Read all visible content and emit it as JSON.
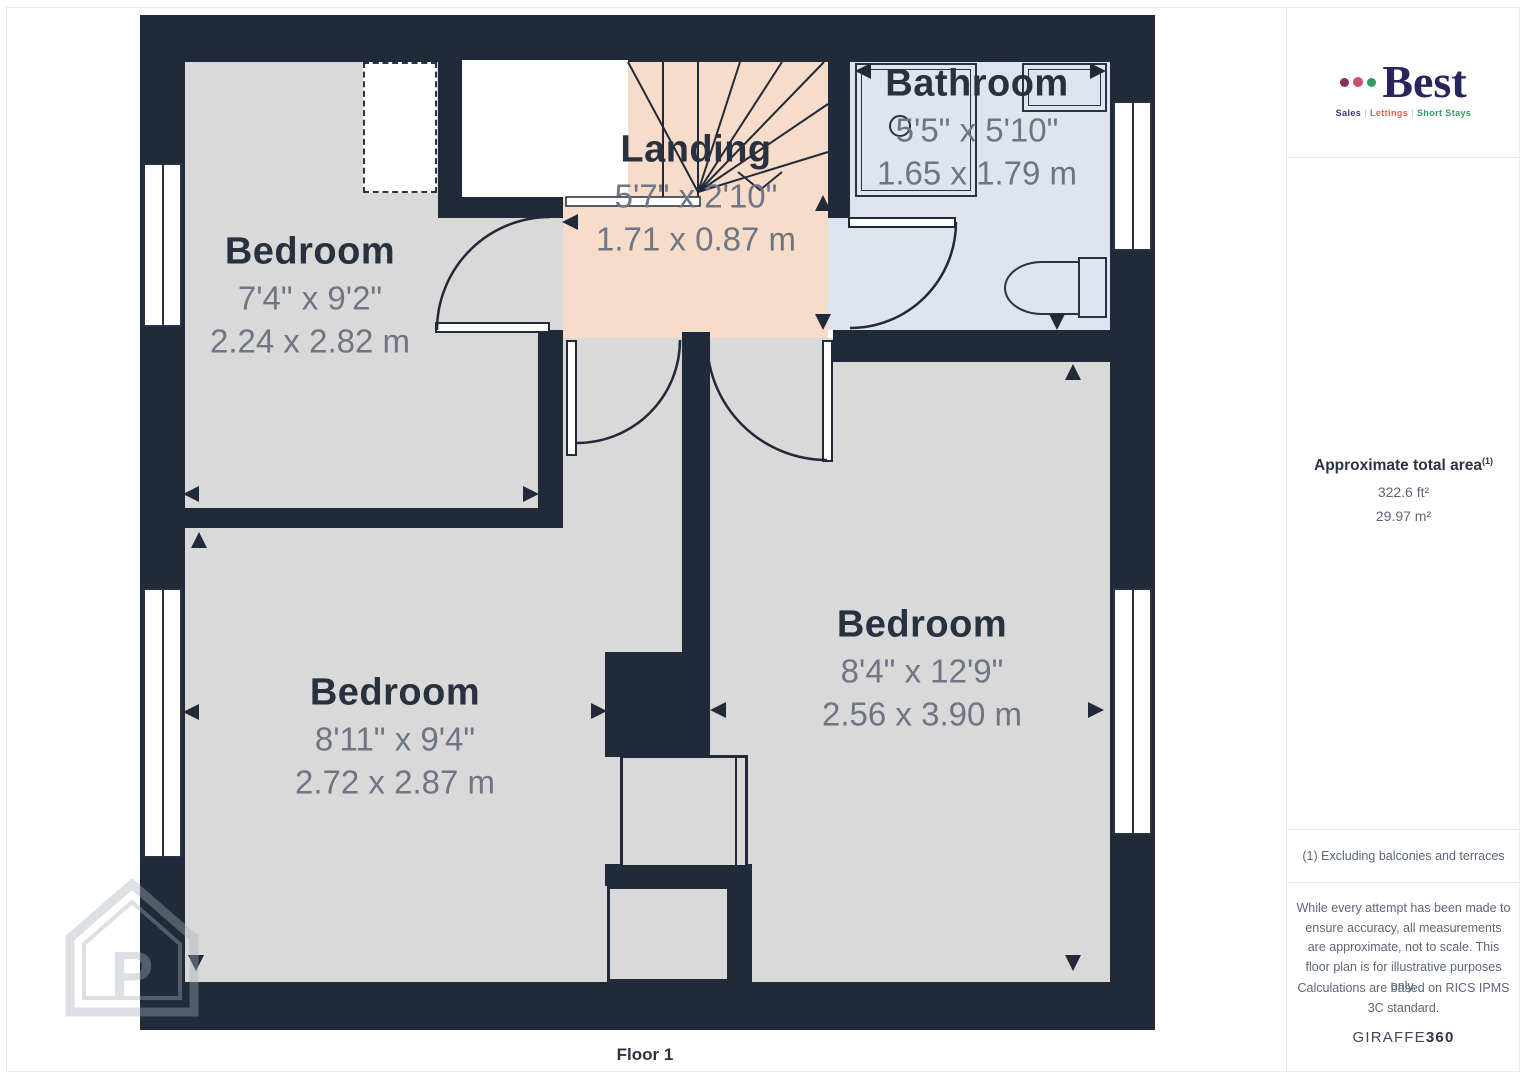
{
  "plan": {
    "floor_label": "Floor 1",
    "rooms": [
      {
        "name": "Bedroom",
        "imperial": "7'4\" x 9'2\"",
        "metric": "2.24 x 2.82 m"
      },
      {
        "name": "Landing",
        "imperial": "5'7\" x 2'10\"",
        "metric": "1.71 x 0.87 m"
      },
      {
        "name": "Bathroom",
        "imperial": "5'5\" x 5'10\"",
        "metric": "1.65 x 1.79 m"
      },
      {
        "name": "Bedroom",
        "imperial": "8'11\" x 9'4\"",
        "metric": "2.72 x 2.87 m"
      },
      {
        "name": "Bedroom",
        "imperial": "8'4\" x 12'9\"",
        "metric": "2.56 x 3.90 m"
      }
    ],
    "watermark_letter": "P",
    "colors": {
      "wall": "#212a38",
      "bedroom_floor": "#d9d9d9",
      "landing_floor": "#f7dcc9",
      "bathroom_floor": "#dfe4ee",
      "title_text": "#27313f",
      "dim_text": "#6e7683"
    }
  },
  "sidebar": {
    "logo": {
      "brand": "Best",
      "tagline": [
        "Sales",
        "Lettings",
        "Short Stays"
      ],
      "separator": "|",
      "dot_colors": [
        "#8c2f55",
        "#c94f6d",
        "#2f9e5f"
      ]
    },
    "area": {
      "title": "Approximate total area",
      "superscript": "(1)",
      "imperial": "322.6 ft²",
      "metric": "29.97 m²"
    },
    "footnote": "(1) Excluding balconies and terraces",
    "disclaimer": "While every attempt has been made to ensure accuracy, all measurements are approximate, not to scale. This floor plan is for illustrative purposes only.",
    "standard": "Calculations are based on RICS IPMS 3C standard.",
    "brand_footer": {
      "giraffe": "GIRAFFE",
      "suffix": "360"
    }
  }
}
